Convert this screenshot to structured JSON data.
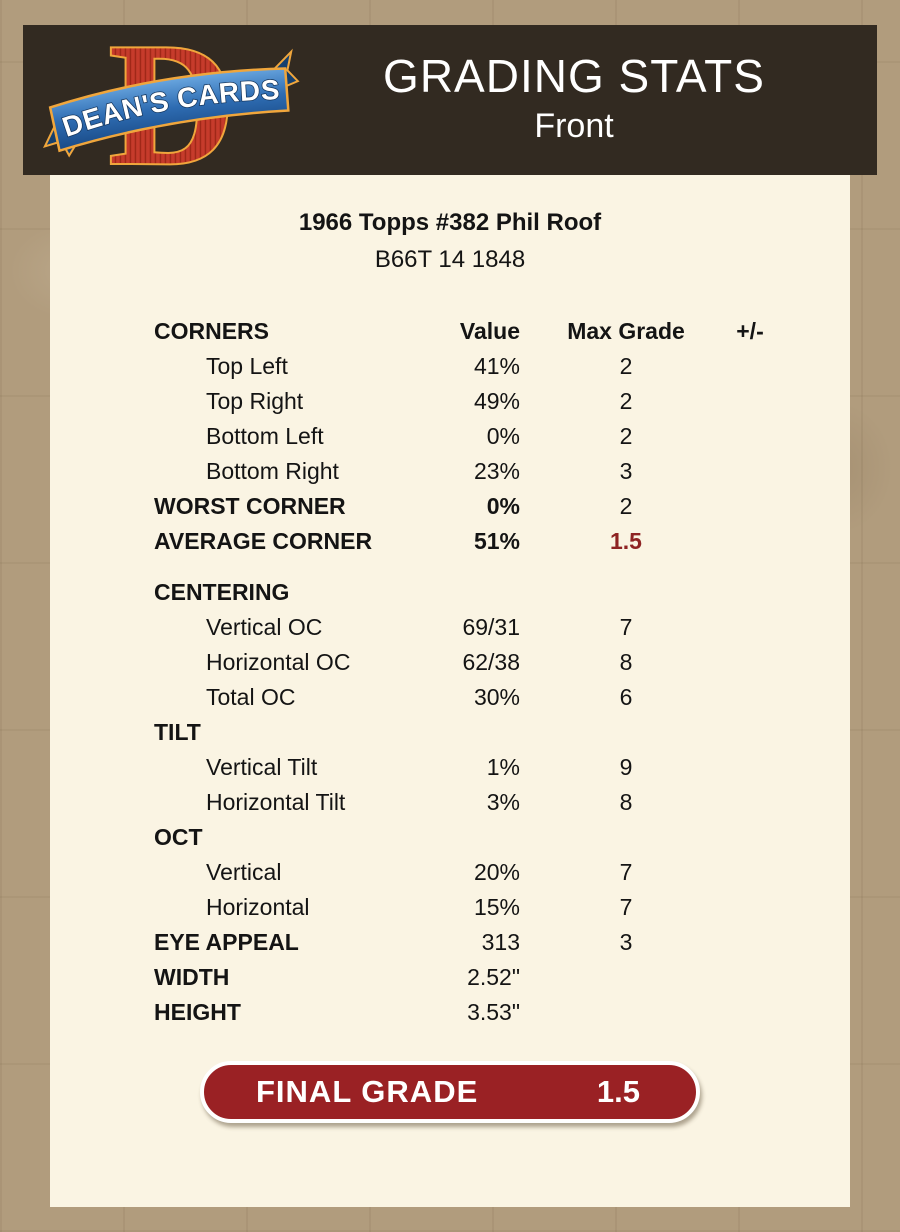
{
  "header": {
    "title": "GRADING STATS",
    "subtitle": "Front",
    "logo": {
      "name": "DEAN'S CARDS",
      "initial": "D"
    }
  },
  "card": {
    "title": "1966 Topps #382 Phil Roof",
    "serial": "B66T 14 1848"
  },
  "table": {
    "header": {
      "label": "CORNERS",
      "value": "Value",
      "grade": "Max Grade",
      "plusminus": "+/-"
    },
    "rows": [
      {
        "label": "Top Left",
        "value": "41%",
        "grade": "2"
      },
      {
        "label": "Top Right",
        "value": "49%",
        "grade": "2"
      },
      {
        "label": "Bottom Left",
        "value": "0%",
        "grade": "2"
      },
      {
        "label": "Bottom Right",
        "value": "23%",
        "grade": "3"
      },
      {
        "label": "WORST CORNER",
        "value": "0%",
        "grade": "2"
      },
      {
        "label": "AVERAGE CORNER",
        "value": "51%",
        "grade": "1.5"
      },
      {
        "label": "CENTERING",
        "value": "",
        "grade": ""
      },
      {
        "label": "Vertical OC",
        "value": "69/31",
        "grade": "7"
      },
      {
        "label": "Horizontal OC",
        "value": "62/38",
        "grade": "8"
      },
      {
        "label": "Total OC",
        "value": "30%",
        "grade": "6"
      },
      {
        "label": "TILT",
        "value": "",
        "grade": ""
      },
      {
        "label": "Vertical Tilt",
        "value": "1%",
        "grade": "9"
      },
      {
        "label": "Horizontal Tilt",
        "value": "3%",
        "grade": "8"
      },
      {
        "label": "OCT",
        "value": "",
        "grade": ""
      },
      {
        "label": "Vertical",
        "value": "20%",
        "grade": "7"
      },
      {
        "label": "Horizontal",
        "value": "15%",
        "grade": "7"
      },
      {
        "label": "EYE APPEAL",
        "value": "313",
        "grade": "3"
      },
      {
        "label": "WIDTH",
        "value": "2.52\"",
        "grade": ""
      },
      {
        "label": "HEIGHT",
        "value": "3.53\"",
        "grade": ""
      }
    ]
  },
  "final_grade": {
    "label": "FINAL GRADE",
    "value": "1.5"
  },
  "colors": {
    "page_background": "#b19c7d",
    "header_bar": "#322a21",
    "content_background": "#faf4e3",
    "accent_red": "#8e2323",
    "final_grade_red": "#9a2124",
    "logo_red": "#c63b2b",
    "logo_gold": "#f0a63c",
    "logo_blue": "#2e6cb2"
  }
}
